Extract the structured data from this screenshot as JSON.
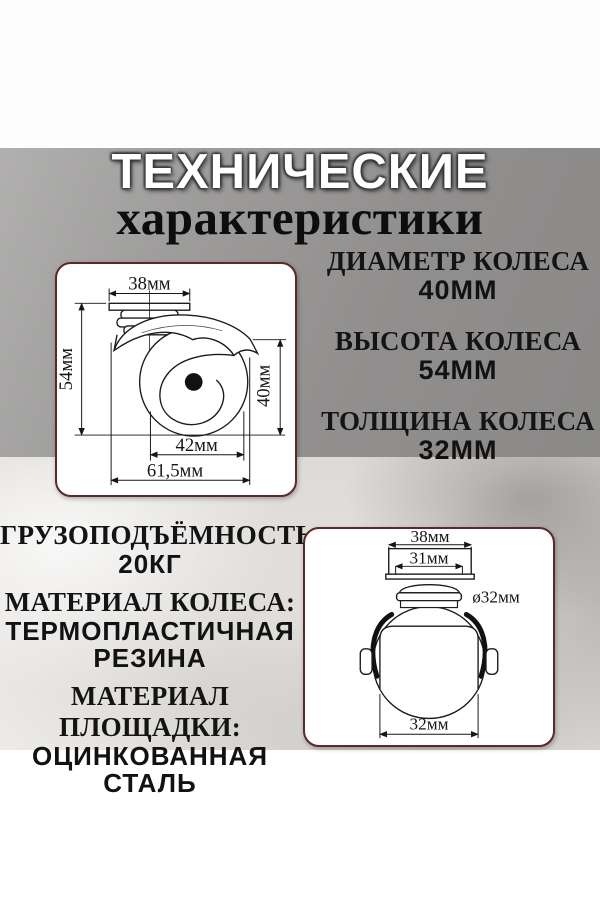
{
  "title": {
    "line1": "ТЕХНИЧЕСКИЕ",
    "line2": "характеристики"
  },
  "specs_right": [
    {
      "label": "ДИАМЕТР КОЛЕСА",
      "value": "40ММ"
    },
    {
      "label": "ВЫСОТА КОЛЕСА",
      "value": "54ММ"
    },
    {
      "label": "ТОЛЩИНА КОЛЕСА",
      "value": "32ММ"
    }
  ],
  "specs_left": [
    {
      "label": "ГРУЗОПОДЪЁМНОСТЬ",
      "value": "20КГ"
    },
    {
      "label": "МАТЕРИАЛ КОЛЕСА:",
      "value": "ТЕРМОПЛАСТИЧНАЯ РЕЗИНА"
    },
    {
      "label": "МАТЕРИАЛ ПЛОЩАДКИ:",
      "value": "ОЦИНКОВАННАЯ СТАЛЬ"
    }
  ],
  "diagram_side": {
    "dim_top": "38мм",
    "dim_left": "54мм",
    "dim_right": "40мм",
    "dim_bottom_inner": "42мм",
    "dim_bottom_outer": "61,5мм"
  },
  "diagram_front": {
    "dim_top": "38мм",
    "dim_top_inner": "31мм",
    "dim_swivel": "ø32мм",
    "dim_bottom": "32мм"
  },
  "colors": {
    "panel_gray": "#949392",
    "texture_light": "#e7e5e2",
    "card_border": "#5c2828",
    "card_bg": "#ffffff",
    "text": "#121212",
    "title_fill": "#ffffff"
  }
}
